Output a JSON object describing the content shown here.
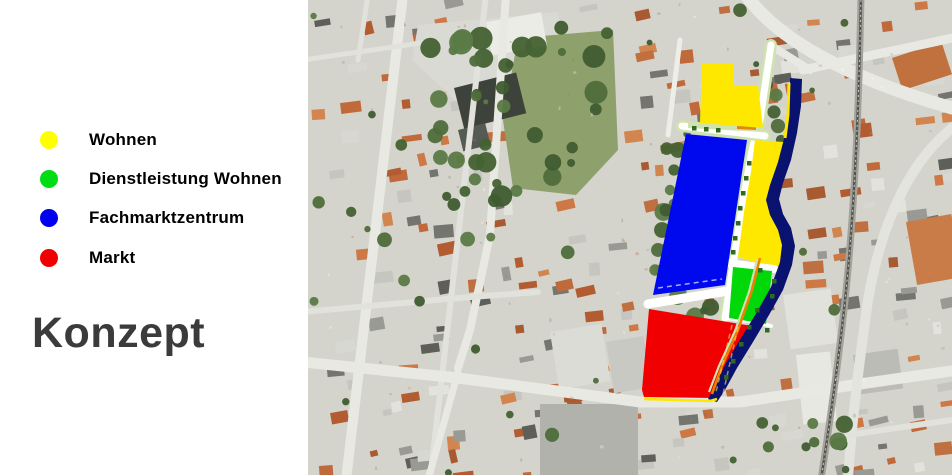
{
  "slide": {
    "title": "Konzept",
    "title_color": "#3b3b3b",
    "background_color": "#ffffff"
  },
  "legend": {
    "items": [
      {
        "label": "Wohnen",
        "color": "#ffff00"
      },
      {
        "label": "Dienstleistung Wohnen",
        "color": "#00dd15"
      },
      {
        "label": "Fachmarktzentrum",
        "color": "#0000f0"
      },
      {
        "label": "Markt",
        "color": "#f00000"
      }
    ]
  },
  "map": {
    "type": "aerial-photo-with-zone-overlay",
    "colors": {
      "zone_yellow": "#ffe800",
      "zone_blue": "#0008ee",
      "zone_green": "#00d80a",
      "zone_red": "#f00000",
      "zone_navy": "#0a1270",
      "street_white": "#ffffff",
      "strip_green": "#cfe3ae",
      "accent_orange": "#f08000",
      "tree_dark": "#2e6b1e"
    },
    "overlay": {
      "zones": [
        {
          "name": "zone-wohnen-nord",
          "color": "#ffe800",
          "points": [
            [
              394,
              63
            ],
            [
              425,
              63
            ],
            [
              425,
              85
            ],
            [
              450,
              85
            ],
            [
              455,
              128
            ],
            [
              392,
              123
            ]
          ]
        },
        {
          "name": "zone-fachmarktzentrum",
          "color": "#0008ee",
          "points": [
            [
              378,
              134
            ],
            [
              439,
              140
            ],
            [
              417,
              285
            ],
            [
              345,
              295
            ]
          ]
        },
        {
          "name": "zone-wohnen-mitte",
          "color": "#ffe800",
          "points": [
            [
              447,
              140
            ],
            [
              476,
              142
            ],
            [
              474,
              162
            ],
            [
              466,
              184
            ],
            [
              461,
              200
            ],
            [
              464,
              214
            ],
            [
              473,
              228
            ],
            [
              477,
              243
            ],
            [
              476,
              266
            ],
            [
              449,
              263
            ],
            [
              430,
              257
            ],
            [
              436,
              212
            ],
            [
              443,
              172
            ]
          ]
        },
        {
          "name": "zone-dienstleistung-wohnen",
          "color": "#00d80a",
          "points": [
            [
              425,
              267
            ],
            [
              464,
              271
            ],
            [
              458,
              324
            ],
            [
              421,
              318
            ]
          ]
        },
        {
          "name": "zone-markt",
          "color": "#f00000",
          "points": [
            [
              341,
              309
            ],
            [
              408,
              320
            ],
            [
              444,
              326
            ],
            [
              433,
              349
            ],
            [
              419,
              372
            ],
            [
              405,
              398
            ],
            [
              336,
              397
            ],
            [
              334,
              390
            ]
          ]
        },
        {
          "name": "zone-bahn-strip",
          "color": "#0a1270",
          "points": [
            [
              482,
              78
            ],
            [
              494,
              79
            ],
            [
              493,
              106
            ],
            [
              489,
              133
            ],
            [
              483,
              160
            ],
            [
              475,
              183
            ],
            [
              471,
              199
            ],
            [
              475,
              214
            ],
            [
              483,
              228
            ],
            [
              487,
              246
            ],
            [
              484,
              265
            ],
            [
              475,
              290
            ],
            [
              461,
              315
            ],
            [
              445,
              342
            ],
            [
              429,
              368
            ],
            [
              417,
              390
            ],
            [
              409,
              402
            ],
            [
              400,
              399
            ],
            [
              406,
              388
            ],
            [
              418,
              363
            ],
            [
              433,
              338
            ],
            [
              449,
              312
            ],
            [
              463,
              287
            ],
            [
              472,
              262
            ],
            [
              474,
              245
            ],
            [
              470,
              230
            ],
            [
              462,
              215
            ],
            [
              458,
              200
            ],
            [
              462,
              185
            ],
            [
              470,
              162
            ],
            [
              477,
              135
            ],
            [
              481,
              108
            ],
            [
              482,
              92
            ]
          ]
        }
      ],
      "streets": [
        {
          "points": [
            [
              463,
              45
            ],
            [
              452,
              120
            ],
            [
              444,
              150
            ],
            [
              436,
              195
            ],
            [
              428,
              245
            ],
            [
              422,
              285
            ],
            [
              417,
              318
            ]
          ],
          "width": 7,
          "under_width": 12
        },
        {
          "points": [
            [
              374,
              126
            ],
            [
              457,
              136
            ]
          ],
          "width": 7,
          "under_width": 12
        },
        {
          "points": [
            [
              340,
              304
            ],
            [
              420,
              291
            ]
          ],
          "width": 9
        },
        {
          "points": [
            [
              420,
              263
            ],
            [
              466,
              269
            ]
          ],
          "width": 8
        },
        {
          "points": [
            [
              417,
              318
            ],
            [
              448,
              322
            ],
            [
              463,
              326
            ]
          ],
          "width": 4
        }
      ],
      "pale_strip": [
        [
          380,
          122
        ],
        [
          455,
          126
        ],
        [
          455,
          132
        ],
        [
          380,
          128
        ]
      ],
      "orange_rect": [
        [
          429,
          123
        ],
        [
          448,
          124
        ],
        [
          448,
          130
        ],
        [
          429,
          129
        ]
      ],
      "yellow_edge_line": [
        [
          481,
          83
        ],
        [
          480,
          115
        ],
        [
          477,
          138
        ]
      ],
      "orange_curve": [
        [
          452,
          258
        ],
        [
          444,
          290
        ],
        [
          430,
          330
        ],
        [
          414,
          366
        ],
        [
          404,
          394
        ]
      ],
      "pale_curve": [
        [
          449,
          260
        ],
        [
          441,
          292
        ],
        [
          427,
          331
        ],
        [
          411,
          366
        ],
        [
          401,
          392
        ]
      ],
      "yellow_bottom_line": [
        [
          336,
          399
        ],
        [
          402,
          401
        ],
        [
          409,
          399
        ]
      ],
      "tree_squares": [
        [
          441,
          163
        ],
        [
          438,
          178
        ],
        [
          435,
          193
        ],
        [
          432,
          208
        ],
        [
          430,
          223
        ],
        [
          427,
          238
        ],
        [
          425,
          252
        ],
        [
          449,
          310
        ],
        [
          441,
          327
        ],
        [
          433,
          344
        ],
        [
          425,
          361
        ],
        [
          418,
          377
        ],
        [
          466,
          281
        ],
        [
          464,
          296
        ],
        [
          386,
          128
        ],
        [
          398,
          129
        ],
        [
          410,
          130
        ],
        [
          452,
          270
        ],
        [
          459,
          330
        ]
      ],
      "dashed_lines": [
        {
          "points": [
            [
              350,
              288
            ],
            [
              414,
              279
            ]
          ],
          "color": "rgba(255,255,255,0.65)"
        },
        {
          "points": [
            [
              424,
              325
            ],
            [
              408,
              392
            ]
          ],
          "color": "rgba(255,225,90,0.6)"
        },
        {
          "points": [
            [
              430,
              327
            ],
            [
              415,
              394
            ]
          ],
          "color": "rgba(255,225,90,0.6)"
        }
      ]
    }
  }
}
